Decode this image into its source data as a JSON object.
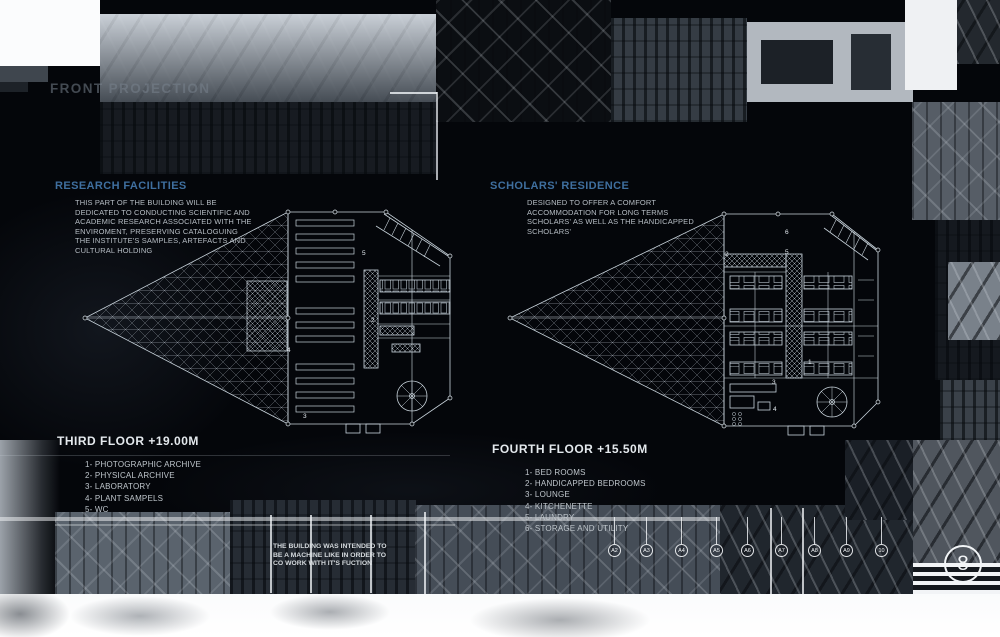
{
  "page": {
    "title": "FRONT PROJECTION",
    "page_number": "8"
  },
  "sections": {
    "research": {
      "heading": "RESEARCH FACILITIES",
      "description_lines": [
        "THIS PART OF THE BUILDING WILL BE",
        "DEDICATED TO CONDUCTING SCIENTIFIC AND",
        "ACADEMIC RESEARCH ASSOCIATED WITH THE",
        "ENVIROMENT, PRESERVING CATALOGUING",
        "THE INSTITUTE'S SAMPLES, ARTEFACTS AND",
        "CULTURAL HOLDING"
      ],
      "floor_label": "THIRD FLOOR +19.00M",
      "legend": [
        "1- PHOTOGRAPHIC ARCHIVE",
        "2- PHYSICAL ARCHIVE",
        "3- LABORATORY",
        "4- PLANT SAMPELS",
        "5- WC"
      ],
      "room_numbers": [
        "5",
        "2",
        "4",
        "3"
      ]
    },
    "residence": {
      "heading": "SCHOLARS' RESIDENCE",
      "description_lines": [
        "DESIGNED TO OFFER A COMFORT",
        "ACCOMMODATION FOR LONG TERMS",
        "SCHOLARS' AS WELL AS THE HANDICAPPED",
        "SCHOLARS'"
      ],
      "floor_label": "FOURTH FLOOR +15.50M",
      "legend": [
        "1- BED ROOMS",
        "2- HANDICAPPED BEDROOMS",
        "3- LOUNGE",
        "4- KITCHENETTE",
        "5- LAUNDRY",
        "6- STORAGE AND UTILITY"
      ],
      "room_numbers": [
        "2",
        "6",
        "5",
        "1",
        "3",
        "4"
      ]
    }
  },
  "quote_lines": [
    "THE BUILDING WAS INTENDED TO",
    "BE A MACHINE LIKE IN ORDER TO",
    "CO WORK WITH IT'S FUCTION"
  ],
  "grid_bubbles": [
    "A2",
    "A3",
    "A4",
    "A5",
    "A6",
    "A7",
    "A8",
    "A9",
    "10"
  ],
  "colors": {
    "heading_blue": "#3f6f9f",
    "body_text": "#b6bdc4",
    "plan_line": "#c8d3db",
    "page_background": "#04060a"
  }
}
